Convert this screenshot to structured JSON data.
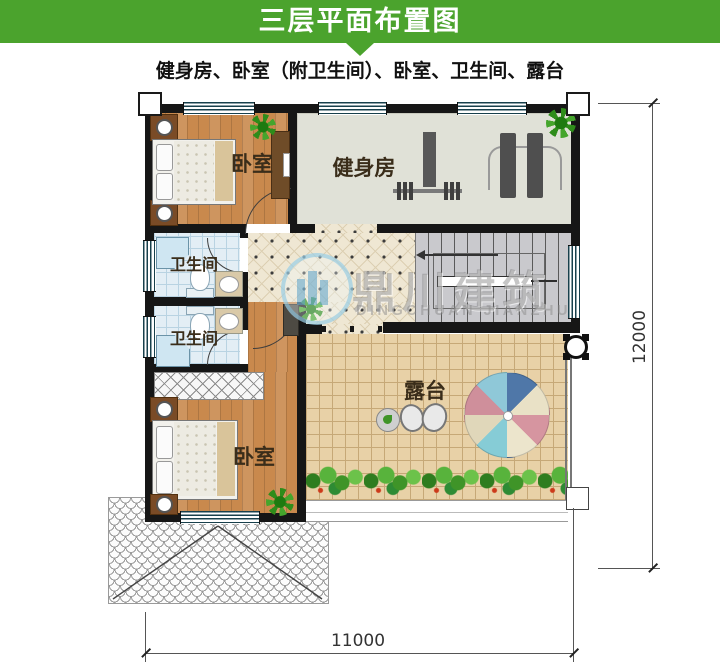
{
  "header": {
    "title": "三层平面布置图"
  },
  "subtitle": "健身房、卧室（附卫生间）、卧室、卫生间、露台",
  "plan": {
    "rooms": [
      {
        "id": "bedroom-top",
        "label": "卧室"
      },
      {
        "id": "gym",
        "label": "健身房"
      },
      {
        "id": "bathroom-upper",
        "label": "卫生间"
      },
      {
        "id": "bathroom-lower",
        "label": "卫生间"
      },
      {
        "id": "bedroom-bottom",
        "label": "卧室"
      },
      {
        "id": "terrace",
        "label": "露台"
      }
    ],
    "dimensions": {
      "width_label": "11000",
      "height_label": "12000"
    }
  },
  "watermark": {
    "brand_cn": "鼎川建筑",
    "brand_en": "DINGCHUAN JIANZHU"
  },
  "colors": {
    "header_green": "#4BA32D",
    "wall": "#161616",
    "wood_floor": "#C9894D",
    "gym_floor": "#E0E1D7",
    "bath_floor": "#E3EEF5",
    "hall_floor": "#EFE7D3",
    "terrace_floor": "#E8D1A7",
    "stair_floor": "#C9C9CD",
    "room_label_text": "#3A2D1A",
    "window_line": "#18404C"
  }
}
